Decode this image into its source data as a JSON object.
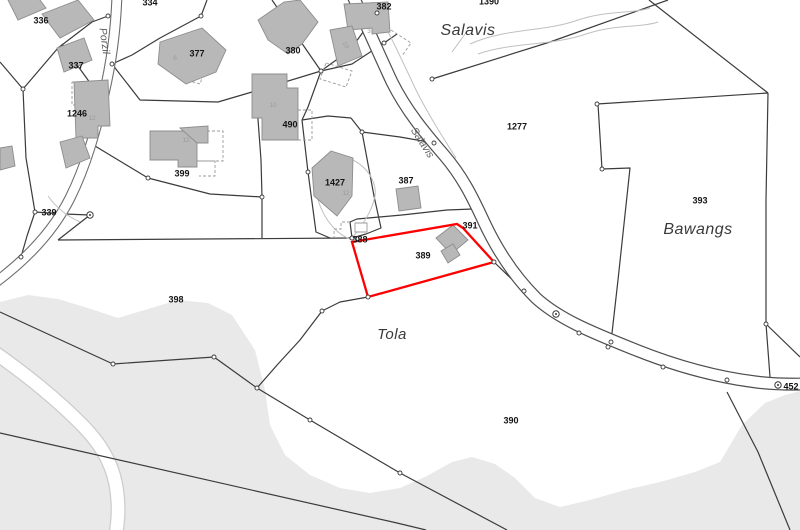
{
  "map": {
    "width": 800,
    "height": 530,
    "colors": {
      "background": "#ffffff",
      "terrain": "#e9e9e9",
      "boundary": "#3b3b3b",
      "building_fill": "#b8b8b8",
      "building_stroke": "#8d8d8d",
      "road_fill": "#ffffff",
      "road_casing_main": "#4f4f4f",
      "road_casing_minor": "#6e6e6e",
      "trail_casing": "#cccccc",
      "light_line": "#c0c0c0",
      "dashed_line": "#9a9a9a",
      "highlight": "#ff0000",
      "parcel_label": "#141414",
      "place_label": "#3a3a3a",
      "street_label": "#5a5a5a",
      "house_number": "#9b9b9b",
      "node_fill": "#ffffff"
    },
    "terrain_polygons": [
      {
        "name": "terrain-south",
        "points": "0,302 28,295 58,299 88,308 118,318 148,309 178,300 208,303 232,315 255,350 265,390 270,425 285,455 310,475 340,488 370,493 400,488 425,477 452,462 472,457 495,464 515,478 535,498 560,507 590,500 625,490 660,482 695,472 720,462 742,425 765,403 785,395 800,391 800,530 0,530"
      }
    ],
    "trails": [
      {
        "name": "trail-southwest",
        "path": "M-6,352 C28,376 60,402 85,428 C104,448 114,468 117,492 C119,508 118,520 116,534",
        "casing": 15,
        "inner": 12.5
      }
    ],
    "boundaries": [
      "0,62 23,89",
      "23,89 26,158 35,212 27,236 21,257 0,283",
      "23,89 58,48 92,22 108,16",
      "35,212 64,214 90,215",
      "58,240 352,238",
      "90,215 72,229 58,240",
      "352,238 350,222 357,219 402,215 447,210 473,209",
      "0,312 113,364 214,357 257,388 310,420 400,473 507,530",
      "368,297 340,302 322,311 300,340 278,364 257,388",
      "0,433 397,523 426,530",
      "494,262 524,291",
      "649,0 768,93",
      "768,93 766,200 766,324",
      "597,104 768,93",
      "598,104 602,169 630,168 618,280 611,342",
      "668,0 550,42 432,79",
      "766,324 800,357",
      "766,324 770,377",
      "727,392 758,452 790,530",
      "95,146 148,178 210,194 262,197",
      "256,92 261,160 262,197 262,238",
      "272,0 321,71 308,107 302,120",
      "321,71 350,50 377,13",
      "321,71 352,64 384,43 397,34",
      "377,13 389,6",
      "207,0 201,16 160,38 132,55 112,64",
      "112,64 140,100 218,102 252,92 321,71",
      "302,120 328,116 351,118",
      "351,118 362,132 374,196 381,228 366,234 352,238",
      "362,132 400,137 434,143",
      "302,120 308,172 316,232 330,238",
      "62,44 93,87 106,96"
    ],
    "roads": [
      {
        "name": "road-salavis",
        "path": "M352,-6 C365,22 378,52 392,82 C406,110 424,132 444,155 C462,176 472,196 484,222 C498,252 516,278 536,298 C560,320 596,334 636,350 C676,366 716,377 756,382 C780,385 795,384 806,384",
        "casing": 13,
        "inner": 10.6,
        "casing_key": "road_casing_main"
      },
      {
        "name": "road-porzil",
        "path": "M117,-6 C116,28 112,60 104,94 C96,130 86,166 70,198 C54,230 28,258 -4,282",
        "casing": 11,
        "inner": 8.8,
        "casing_key": "road_casing_minor"
      }
    ],
    "light_paths": [
      "M470,44 C505,28 545,32 578,20 C608,10 632,14 650,8",
      "M478,54 C512,42 552,46 586,34 C616,24 640,28 658,22",
      "M468,30 L452,52",
      "M48,196 Q60,213 80,222",
      "M318,200 C325,222 338,235 352,240",
      "M353,160 C372,170 378,188 374,200 C371,212 362,226 352,238",
      "M372,2 C388,30 402,60 416,90 C428,114 442,136 456,158"
    ],
    "dashed_lines": [
      "72,82 105,82 105,105 72,105 72,82",
      "197,131 223,131 223,161 197,161",
      "199,161 215,161 215,176 199,176",
      "391,30 411,43 402,56",
      "326,63 352,71 346,87 320,79 326,63",
      "186,60 206,66 200,84 180,78 186,60",
      "298,110 312,110 312,140 298,140",
      "350,222 341,222 341,229 334,229 334,238"
    ],
    "minor_structures": [
      {
        "name": "shed-outline",
        "points": "355,223 367,223 367,232 355,232"
      }
    ],
    "buildings": [
      "8,0 34,-8 46,8 18,20",
      "42,14 78,0 94,20 60,38",
      "57,48 84,38 92,60 64,72",
      "74,82 108,80 110,126 98,126 98,138 76,138",
      "60,142 82,136 90,158 66,168",
      "0,148 12,146 15,166 0,170",
      "160,42 202,28 226,50 216,72 186,84 158,64",
      "258,20 284,2 300,0 318,22 302,44 288,54 268,40",
      "344,4 388,2 390,32 372,34 372,28 348,30",
      "330,30 352,26 362,56 338,66",
      "252,74 287,74 287,88 298,88 298,140 262,140 262,118 252,118",
      "150,131 197,131 197,167 178,167 178,160 150,160",
      "180,128 208,126 208,143 197,143",
      "312,168 331,151 353,158 352,196 337,216 314,196",
      "396,189 418,186 421,208 399,211",
      "436,238 453,225 468,240 451,254",
      "441,251 453,244 460,255 448,263"
    ],
    "highlight_parcel": {
      "id": "389",
      "points": "352,242 457,224 463,228 494,262 368,297",
      "stroke_width": 2.3
    },
    "nodes": [
      [
        23,
        89
      ],
      [
        35,
        212
      ],
      [
        21,
        257
      ],
      [
        108,
        16
      ],
      [
        201,
        16
      ],
      [
        321,
        71
      ],
      [
        377,
        13
      ],
      [
        384,
        43
      ],
      [
        434,
        143
      ],
      [
        494,
        262
      ],
      [
        524,
        291
      ],
      [
        322,
        311
      ],
      [
        113,
        364
      ],
      [
        214,
        357
      ],
      [
        663,
        367
      ],
      [
        727,
        380
      ],
      [
        766,
        324
      ],
      [
        602,
        169
      ],
      [
        611,
        342
      ],
      [
        352,
        238
      ],
      [
        368,
        297
      ],
      [
        308,
        172
      ],
      [
        362,
        132
      ],
      [
        597,
        104
      ],
      [
        400,
        473
      ],
      [
        310,
        420
      ],
      [
        257,
        388
      ],
      [
        432,
        79
      ],
      [
        262,
        197
      ],
      [
        112,
        64
      ],
      [
        579,
        333
      ],
      [
        608,
        347
      ],
      [
        148,
        178
      ]
    ],
    "survey_points": [
      [
        90,
        215
      ],
      [
        556,
        314
      ],
      [
        778,
        385
      ]
    ],
    "parcel_labels": [
      {
        "text": "334",
        "x": 150,
        "y": 3
      },
      {
        "text": "336",
        "x": 41,
        "y": 21
      },
      {
        "text": "337",
        "x": 76,
        "y": 66
      },
      {
        "text": "377",
        "x": 197,
        "y": 54
      },
      {
        "text": "380",
        "x": 293,
        "y": 51
      },
      {
        "text": "382",
        "x": 384,
        "y": 7
      },
      {
        "text": "1246",
        "x": 77,
        "y": 114
      },
      {
        "text": "490",
        "x": 290,
        "y": 125
      },
      {
        "text": "399",
        "x": 182,
        "y": 174
      },
      {
        "text": "339",
        "x": 49,
        "y": 213
      },
      {
        "text": "1427",
        "x": 335,
        "y": 183
      },
      {
        "text": "387",
        "x": 406,
        "y": 181
      },
      {
        "text": "388",
        "x": 360,
        "y": 240
      },
      {
        "text": "389",
        "x": 423,
        "y": 256
      },
      {
        "text": "391",
        "x": 470,
        "y": 226
      },
      {
        "text": "1277",
        "x": 517,
        "y": 127
      },
      {
        "text": "1390",
        "x": 489,
        "y": 2
      },
      {
        "text": "393",
        "x": 700,
        "y": 201
      },
      {
        "text": "398",
        "x": 176,
        "y": 300
      },
      {
        "text": "390",
        "x": 511,
        "y": 421
      },
      {
        "text": "452",
        "x": 791,
        "y": 387
      }
    ],
    "house_numbers": [
      {
        "text": "6",
        "x": 175,
        "y": 60,
        "rotate": 0
      },
      {
        "text": "12",
        "x": 92,
        "y": 120,
        "rotate": 0
      },
      {
        "text": "12",
        "x": 186,
        "y": 142,
        "rotate": 0
      },
      {
        "text": "10",
        "x": 273,
        "y": 107,
        "rotate": 0
      },
      {
        "text": "10",
        "x": 344,
        "y": 46,
        "rotate": 60
      },
      {
        "text": "3",
        "x": 369,
        "y": 33,
        "rotate": 0
      },
      {
        "text": "12",
        "x": 346,
        "y": 195,
        "rotate": 0
      }
    ],
    "place_labels": [
      {
        "text": "Salavis",
        "x": 468,
        "y": 31,
        "size": 16
      },
      {
        "text": "Bawangs",
        "x": 698,
        "y": 230,
        "size": 16
      },
      {
        "text": "Tola",
        "x": 392,
        "y": 335,
        "size": 15
      }
    ],
    "street_labels": [
      {
        "text": "Porzil",
        "x": 104,
        "y": 41,
        "rotate": 82,
        "size": 10.5
      },
      {
        "text": "Salavis",
        "x": 422,
        "y": 143,
        "rotate": 57,
        "size": 10.5
      }
    ]
  }
}
